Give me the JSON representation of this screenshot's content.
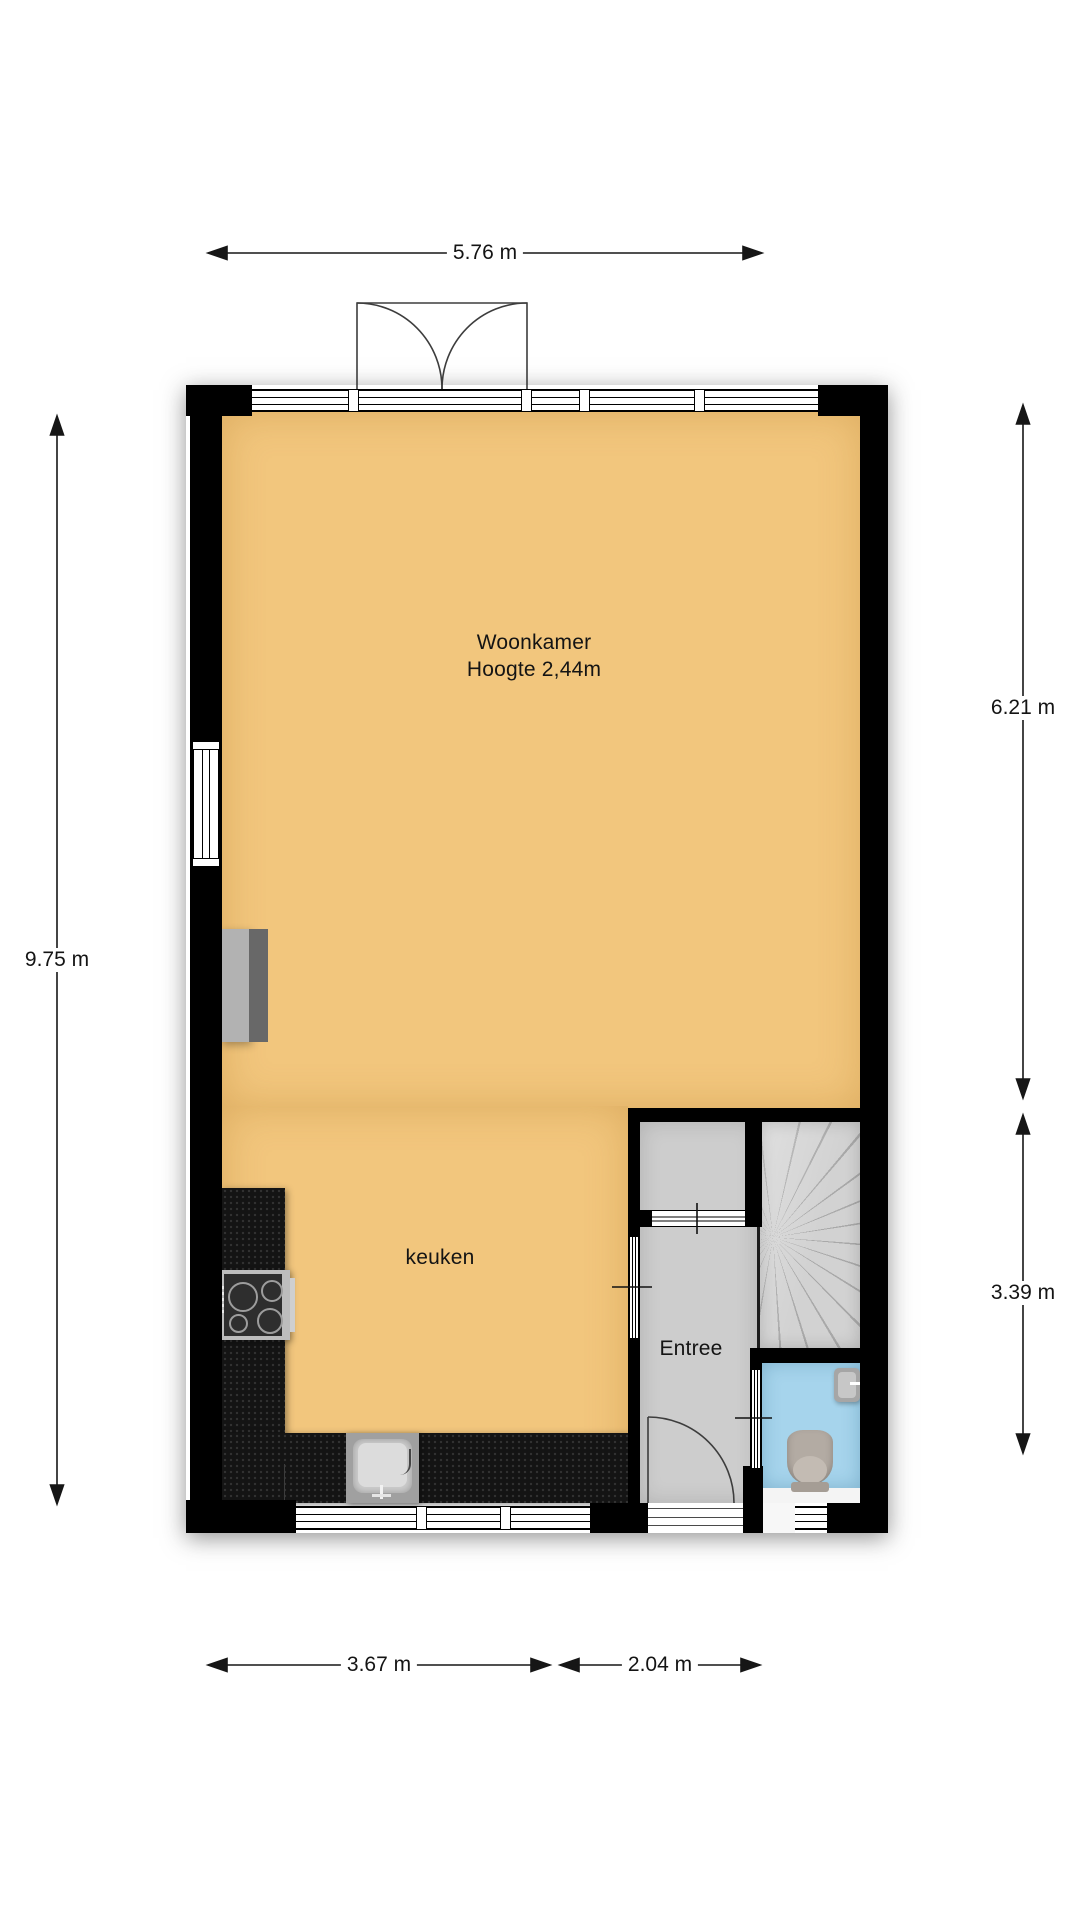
{
  "title": "Begane grond plattegrond",
  "rooms": {
    "woonkamer": {
      "label": "Woonkamer",
      "height_note": "Hoogte 2,44m"
    },
    "keuken": {
      "label": "keuken"
    },
    "entree": {
      "label": "Entree"
    }
  },
  "dimensions": {
    "top": "5.76 m",
    "left": "9.75 m",
    "right_upper": "6.21 m",
    "right_lower": "3.39 m",
    "bottom_left": "3.67 m",
    "bottom_right": "2.04 m"
  },
  "fixtures": [
    "double-garden-door",
    "front-door",
    "spiral-stairs",
    "toilet",
    "hand-basin",
    "kitchen-counter",
    "cooktop",
    "sink",
    "fireplace"
  ],
  "colors": {
    "floor_main": "#f2c67d",
    "floor_hall": "#cdcdcd",
    "floor_toilet": "#a6d4ec",
    "wall": "#000000",
    "counter": "#141414",
    "dimension_text": "#141414",
    "background": "#ffffff"
  }
}
